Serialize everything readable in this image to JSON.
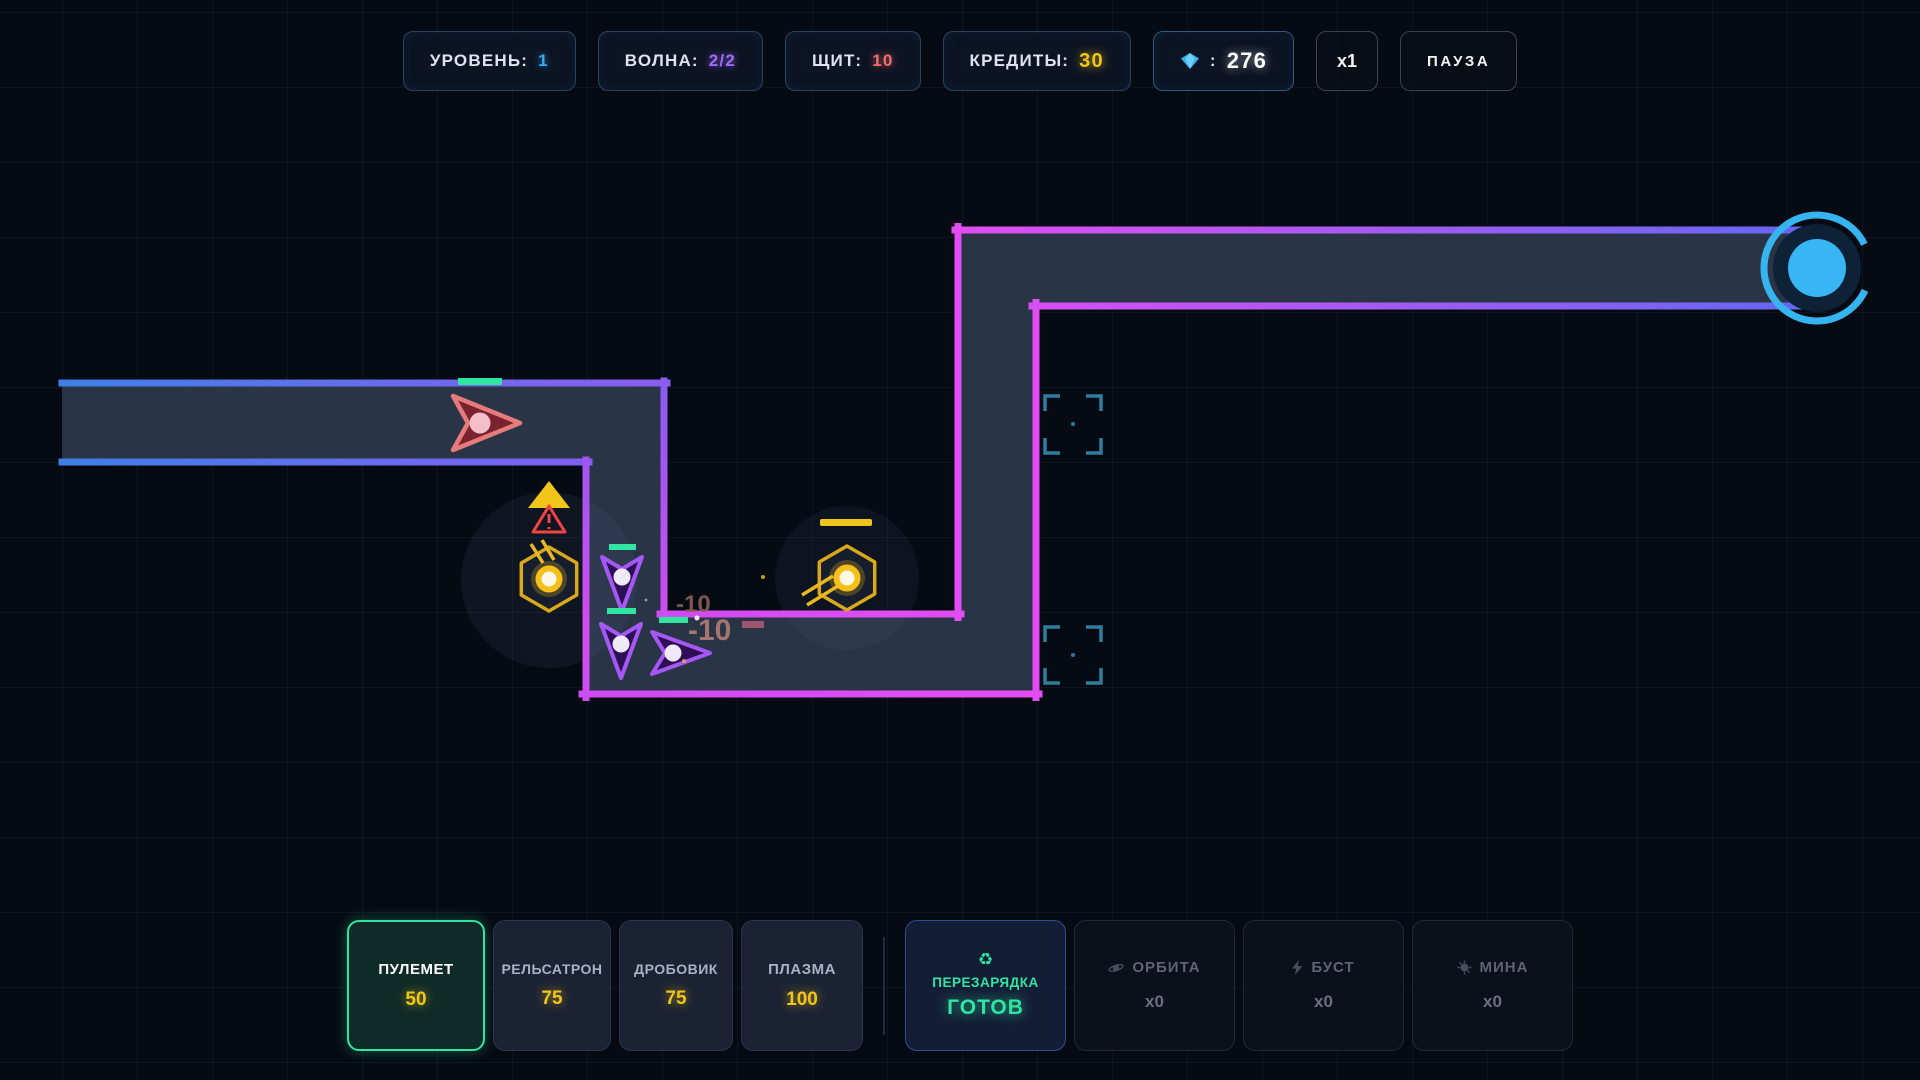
{
  "hud": {
    "level_label": "УРОВЕНЬ:",
    "level_value": "1",
    "wave_label": "ВОЛНА:",
    "wave_value": "2/2",
    "shield_label": "ЩИТ:",
    "shield_value": "10",
    "credits_label": "КРЕДИТЫ:",
    "credits_value": "30",
    "gems_sep": ":",
    "gems_value": "276",
    "speed_label": "x1",
    "pause_label": "ПАУЗА"
  },
  "toolbar": {
    "towers": [
      {
        "label": "ПУЛЕМЕТ",
        "price": "50",
        "selected": true
      },
      {
        "label": "РЕЛЬСАТРОН",
        "price": "75",
        "selected": false
      },
      {
        "label": "ДРОБОВИК",
        "price": "75",
        "selected": false
      },
      {
        "label": "ПЛАЗМА",
        "price": "100",
        "selected": false
      }
    ],
    "reload": {
      "label": "ПЕРЕЗАРЯДКА",
      "status": "ГОТОВ",
      "icon": "recycle-icon"
    },
    "abilities": [
      {
        "label": "ОРБИТА",
        "count": "x0",
        "icon": "orbit-icon"
      },
      {
        "label": "БУСТ",
        "count": "x0",
        "icon": "bolt-icon"
      },
      {
        "label": "МИНА",
        "count": "x0",
        "icon": "mine-icon"
      }
    ]
  },
  "battlefield": {
    "damage_numbers": [
      {
        "text": "-10"
      },
      {
        "text": "-10"
      }
    ]
  },
  "colors": {
    "path_border_start": "#3f7fe6",
    "path_border_mid": "#e14df2",
    "path_border_end": "#6468f0",
    "path_interior": "#2a3447",
    "enemy_red": "#e57b7b",
    "enemy_purple": "#a459f5",
    "health_green": "#2fe5a0",
    "tower_yellow": "#e8b820",
    "portal_blue": "#38b6f4",
    "slot_teal": "#2e7d9d",
    "accent_green": "#2fe5a0",
    "credits_yellow": "#f2c51a",
    "damage_brown": "#a3756f"
  }
}
